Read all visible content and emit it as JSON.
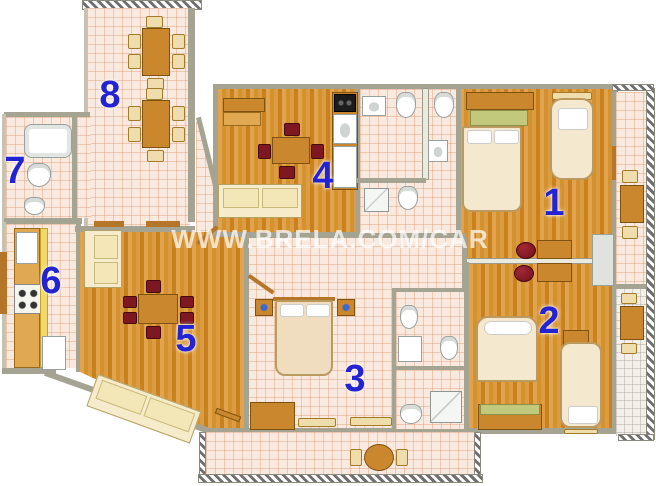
{
  "watermark": {
    "text": "WWW.BRELA.COM/CAR"
  },
  "rooms": [
    {
      "number": "1"
    },
    {
      "number": "2"
    },
    {
      "number": "3"
    },
    {
      "number": "4"
    },
    {
      "number": "5"
    },
    {
      "number": "6"
    },
    {
      "number": "7"
    },
    {
      "number": "8"
    }
  ],
  "palette": {
    "room_number_blue": "#2323d3",
    "wood_floor": "#d3922f",
    "tile_pink": "#f9e9df",
    "tile_grid_line": "#de9e76",
    "wall_gray": "#a5a392",
    "furniture_wood": "#ca872d",
    "chair_dark_red": "#7d1722",
    "sofa_cream": "#f6eccb",
    "watermark_white": "#ffffff"
  }
}
